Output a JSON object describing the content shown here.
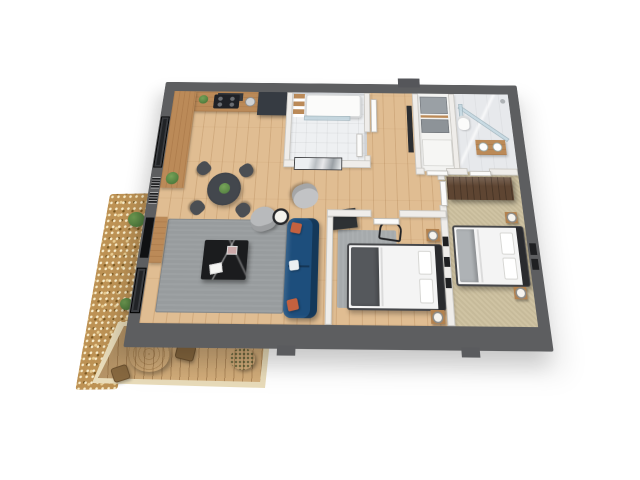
{
  "scene": {
    "type": "3d-isometric-apartment-floorplan-render",
    "background": "#ffffff",
    "colors": {
      "page-bg": "#ffffff",
      "outer-wall": "#5d5e60",
      "inner-wall": "#efedea",
      "wood-floor": "#e0bd92",
      "deck-wood": "#d3ad7a",
      "deck-curb": "#e9dcba",
      "gravel": "#bd9254",
      "tile-light": "#eef0f2",
      "marble": "#e7e9ec",
      "cabinet-dark": "#363b42",
      "counter-wood": "#bb8a58",
      "sofa-blue": "#1d4e7c",
      "pillow-orange": "#c4613f",
      "rug-gray": "#989c9e",
      "table-black": "#1b1c1e",
      "armchair-gray": "#b8babc",
      "chair-dark": "#4b4e53",
      "carpet-beige": "#cfc3a3",
      "wardrobe-walnut": "#5e4532",
      "bed-white": "#f4f4f4",
      "blanket-gray": "#aeb2b5",
      "headboard-dark": "#2a2b2e",
      "nightstand-wood": "#b3824f",
      "plant-green": "#4d7a3c",
      "glass-blue": "#c3d8e2",
      "door-white": "#fbfbfa",
      "frame-black": "#1f2022"
    },
    "rooms": [
      {
        "name": "living-room-with-kitchen-and-dining",
        "floor": "wood"
      },
      {
        "name": "main-bathroom-with-tub",
        "floor": "tile"
      },
      {
        "name": "entry-hallway",
        "floor": "wood"
      },
      {
        "name": "storage-closet",
        "floor": "white"
      },
      {
        "name": "ensuite-shower-bathroom",
        "floor": "marble"
      },
      {
        "name": "bedroom-1",
        "floor": "wood"
      },
      {
        "name": "bedroom-2",
        "floor": "carpet"
      },
      {
        "name": "terrace-with-deck-and-gravel",
        "floor": "deck-boards"
      }
    ],
    "furniture": [
      "kitchen-counter",
      "cooktop",
      "tall-cabinets",
      "range-hood",
      "kitchen-sink",
      "dining-table-with-plant",
      "dining-chairs-x4",
      "area-rug",
      "marble-coffee-table",
      "blue-sofa-with-pillows",
      "armchair-x2",
      "floor-lamp",
      "tv-console",
      "wall-tv",
      "windows",
      "wall-art-frames",
      "marble-artwork",
      "bathtub-with-glass-screen",
      "towel-shelf",
      "entry-door",
      "hall-mirror",
      "storage-boxes",
      "utility-cabinet",
      "glass-shower",
      "wood-vanity-with-sinks",
      "toilet",
      "double-bed-x2",
      "nightstands-with-lamps",
      "wire-chair",
      "dark-closet-nook",
      "walnut-wardrobe",
      "terrace-round-table",
      "terrace-chairs-x2",
      "bush",
      "shrubs"
    ]
  }
}
